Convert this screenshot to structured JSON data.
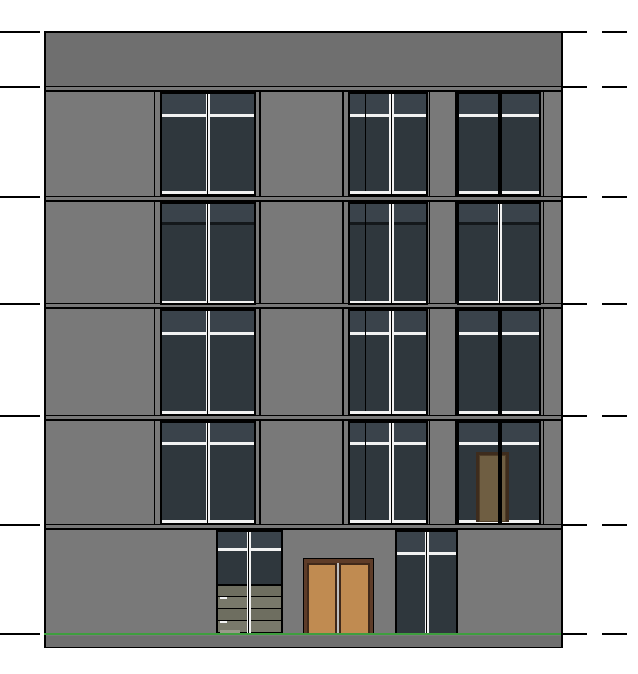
{
  "view": {
    "kind": "building-elevation-drawing",
    "background": "#ffffff",
    "width": 638,
    "height": 674
  },
  "palette": {
    "line": "#000000",
    "wall": "#797979",
    "parapet": "#6f6f6f",
    "pane": "#2f373d",
    "transom_pane": "#3a434b",
    "white": "#f2f2f2",
    "bar_dark": "#14181b",
    "door_frame": "#5e3c28",
    "door_leaf_border": "#40291a",
    "door_panel": "#c08b51",
    "door_meet_light": "#bfbfbf",
    "balcony_frame": "#3e2c1d",
    "balcony_panel": "#6f5e42",
    "balcony_inner": "#503e28",
    "slat_a": "#6e6e60",
    "slat_b": "#79796b",
    "slat_light": "#9a9a8a",
    "grade_green": "#3f9e3f",
    "base_band": "#6f6f6f"
  },
  "building": {
    "x": 44,
    "y": 31,
    "w": 519,
    "h": 617,
    "border": 2,
    "parapet_top": 33,
    "parapet_bottom": 87
  },
  "levels": [
    32,
    87,
    197,
    304,
    416,
    525,
    634
  ],
  "left_tick": {
    "x": 0,
    "len": 40,
    "th": 2
  },
  "right_ticks": [
    [
      561,
      587
    ],
    [
      602,
      627
    ]
  ],
  "slab_ys": [
    87,
    197,
    304,
    416,
    525
  ],
  "floors": [
    {
      "name": "floor-5",
      "top": 87,
      "bottom": 197,
      "win_top": 93.5,
      "bar_y": 113.5,
      "bar": "white",
      "sill_y": 191,
      "c_mullion": "black"
    },
    {
      "name": "floor-4",
      "top": 197,
      "bottom": 304,
      "win_top": 203.5,
      "bar_y": 221.5,
      "bar": "black",
      "sill_y": 300.5,
      "c_mullion": "white"
    },
    {
      "name": "floor-3",
      "top": 304,
      "bottom": 416,
      "win_top": 311,
      "bar_y": 331.5,
      "bar": "white",
      "sill_y": 411,
      "c_mullion": "black"
    },
    {
      "name": "floor-2",
      "top": 416,
      "bottom": 525,
      "win_top": 423,
      "bar_y": 441.5,
      "bar": "white",
      "sill_y": 520,
      "c_mullion": "black"
    }
  ],
  "columns": [
    {
      "id": "a",
      "panel_l": 153.5,
      "panel_r": 259,
      "win_l": 162,
      "win_r": 253.5,
      "mullion": "white",
      "mullion_x": 205.5,
      "extra_line_x": null
    },
    {
      "id": "b",
      "panel_l": 342,
      "panel_r": 428.5,
      "win_l": 350,
      "win_r": 425.5,
      "mullion": "white",
      "mullion_x": 389,
      "extra_line_x": 364.5
    },
    {
      "id": "c",
      "panel_l": 455,
      "panel_r": 542.5,
      "win_l": 458.5,
      "win_r": 539,
      "mullion": "per-floor",
      "mullion_x": 497.5,
      "extra_line_x": null
    }
  ],
  "balcony_door": {
    "floor": "floor-2",
    "column": "c",
    "x": 476,
    "y": 451.5,
    "w": 32.5,
    "h": 70
  },
  "ground": {
    "top": 525,
    "stair_window": {
      "x": 218,
      "y": 531.5,
      "w": 62.5,
      "bar_y": 548,
      "mullion_x": 246.5,
      "slat_top": 584,
      "slat_lines": [
        595.5,
        607.5,
        619.5
      ],
      "slat_bottom": 631.5,
      "bottom": 633,
      "tick_ys": [
        596.5,
        620.5
      ]
    },
    "entry_door": {
      "x": 302.5,
      "y": 558,
      "w": 71,
      "bottom": 634.5
    },
    "window_d": {
      "x": 397,
      "y": 531.5,
      "w": 59,
      "bar_y": 552,
      "mullion_x": 424.5,
      "bottom": 633.5
    },
    "grade_line": {
      "y": 633.2,
      "h": 2.3
    },
    "base_band_bottom": 646.5
  }
}
